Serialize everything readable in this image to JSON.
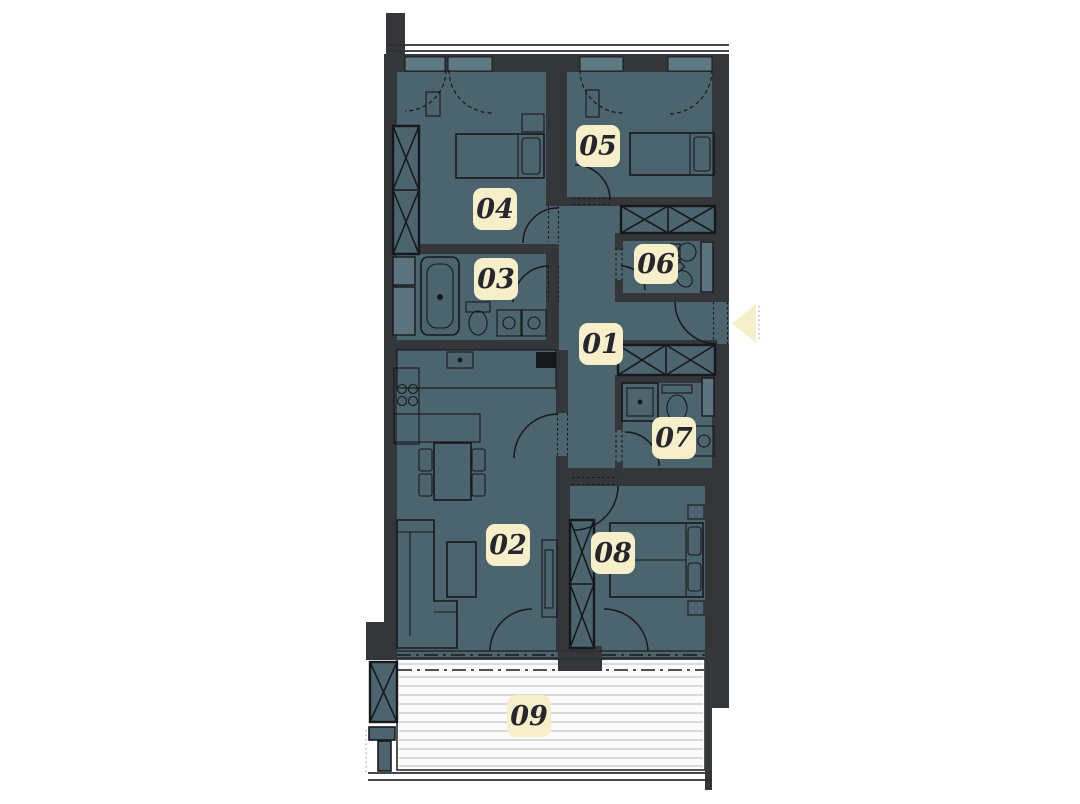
{
  "title": "apartment-floor-plan",
  "colors": {
    "background": "#ffffff",
    "room_fill": "#4b646e",
    "wall": "#35363a",
    "line": "#17181c",
    "window_fill": "#5f7982",
    "duct_fill": "#5b737c",
    "label_bg": "#f6efca",
    "label_text": "#26262e",
    "balcony_floor": "#fbfbfb",
    "balcony_stripe": "#c9cfd0"
  },
  "rooms": [
    {
      "id": "room-01",
      "label": "01"
    },
    {
      "id": "room-02",
      "label": "02"
    },
    {
      "id": "room-03",
      "label": "03"
    },
    {
      "id": "room-04",
      "label": "04"
    },
    {
      "id": "room-05",
      "label": "05"
    },
    {
      "id": "room-06",
      "label": "06"
    },
    {
      "id": "room-07",
      "label": "07"
    },
    {
      "id": "room-08",
      "label": "08"
    },
    {
      "id": "room-09",
      "label": "09"
    }
  ],
  "entrance": {
    "direction": "left"
  }
}
